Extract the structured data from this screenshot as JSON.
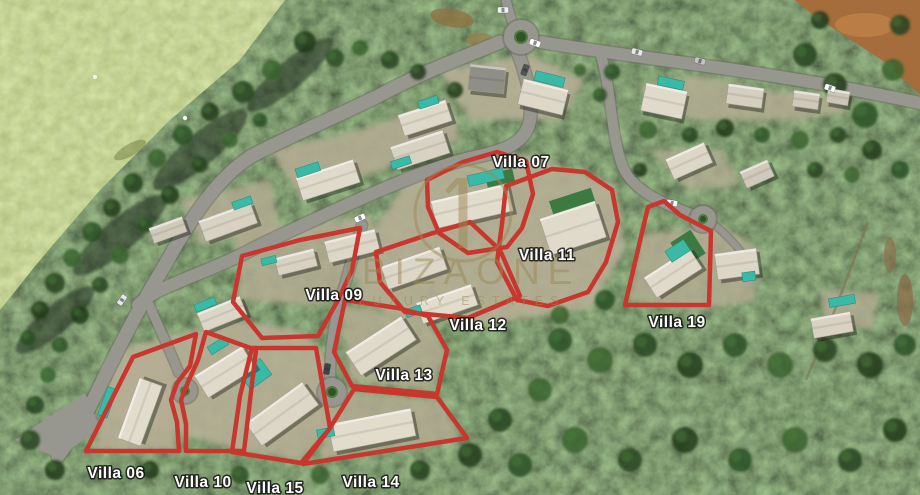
{
  "site_plan": {
    "watermark": {
      "brand": "IBIZAONE",
      "tagline": "LUXURY ESTATES",
      "color": "#9a8754"
    },
    "colors": {
      "plot_outline": "#c9362e",
      "plot_label": "#ffffff"
    },
    "villas": [
      {
        "id": "villa-07",
        "label": "Villa 07",
        "label_x": 521,
        "label_y": 167,
        "outline": "427,180 463,162 497,152 526,161 533,194 522,228 507,247 468,253 439,233 428,207"
      },
      {
        "id": "villa-11",
        "label": "Villa 11",
        "label_x": 547,
        "label_y": 260,
        "outline": "506,186 552,169 585,172 612,190 618,222 606,262 588,292 548,306 517,300 497,262 502,224"
      },
      {
        "id": "villa-09",
        "label": "Villa 09",
        "label_x": 334,
        "label_y": 300,
        "outline": "242,256 300,240 360,228 352,270 338,300 318,336 262,338 233,302"
      },
      {
        "id": "villa-12",
        "label": "Villa 12",
        "label_x": 478,
        "label_y": 330,
        "outline": "376,252 430,234 470,222 500,250 520,296 468,318 405,312 380,282"
      },
      {
        "id": "villa-19",
        "label": "Villa 19",
        "label_x": 677,
        "label_y": 327,
        "outline": "648,207 664,201 680,215 711,231 709,305 625,305"
      },
      {
        "id": "villa-13",
        "label": "Villa 13",
        "label_x": 404,
        "label_y": 380,
        "outline": "345,300 398,308 428,316 447,350 437,394 352,386 334,352"
      },
      {
        "id": "villa-06",
        "label": "Villa 06",
        "label_x": 116,
        "label_y": 478,
        "outline": "86,451 133,357 196,334 190,366 177,383 171,400 177,422 179,451"
      },
      {
        "id": "villa-10",
        "label": "Villa 10",
        "label_x": 203,
        "label_y": 487,
        "outline": "206,332 256,350 244,451 186,451 186,424 181,400 188,382 198,360"
      },
      {
        "id": "villa-15",
        "label": "Villa 15",
        "label_x": 275,
        "label_y": 493,
        "outline": "252,348 316,348 330,428 301,463 232,452 240,396"
      },
      {
        "id": "villa-14",
        "label": "Villa 14",
        "label_x": 371,
        "label_y": 487,
        "outline": "354,389 437,397 467,438 303,464 330,428"
      }
    ]
  }
}
